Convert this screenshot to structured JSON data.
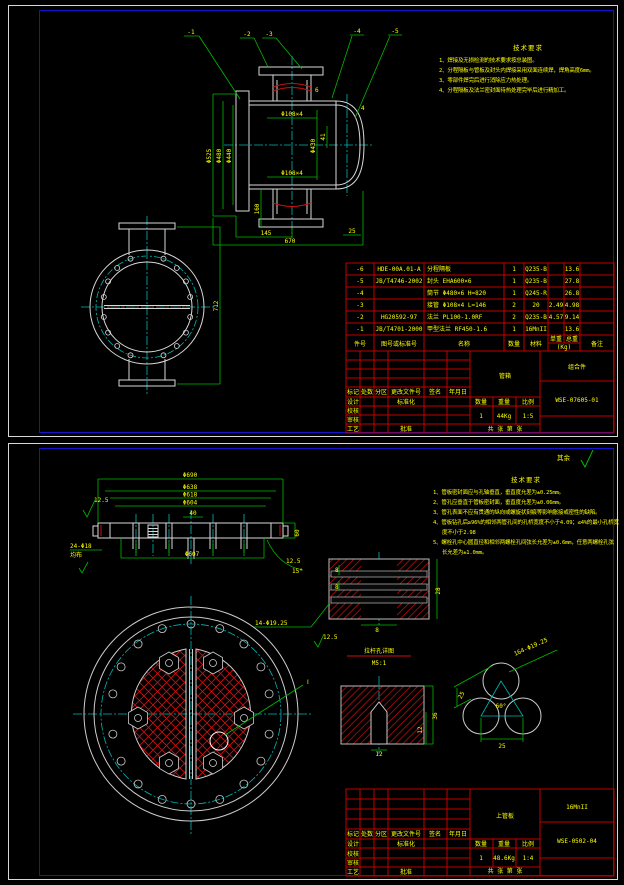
{
  "colors": {
    "background": "#000000",
    "geometry_line": "#d8d8d8",
    "dimension_line": "#00bb00",
    "annotation_text": "#ffff00",
    "centerline": "#00b7b7",
    "table_grid": "#c40000",
    "hatch_red": "#cc1111",
    "frame_blue": "#1414cc"
  },
  "sheet1": {
    "callouts": {
      "c1": "-1",
      "c2": "-2",
      "c3": "-3",
      "c4": "-4",
      "c5": "-5"
    },
    "tech": {
      "title": "技术要求",
      "l1": "1、焊接及无损检测的技术要求按总装图。",
      "l2": "2、分程隔板与管板及封头内焊接采用双面连续焊，焊角高度6mm。",
      "l3": "3、零部件焊完后进行消除应力热处理。",
      "l4": "4、分程隔板及法兰密封面待热处理完毕后进行精加工。"
    },
    "dims": {
      "dia_flange": "Φ525",
      "dia_shell": "Φ480",
      "dia_inner": "Φ440",
      "nozzle_top": "Φ108×4",
      "nozzle_bottom": "Φ108×4",
      "shell_thk": "6",
      "head_thk": "4",
      "dia_mid": "Φ430",
      "len_41": "41",
      "nozzle_height": "160",
      "len_145": "145",
      "len_670": "670",
      "len_25": "25",
      "height_712": "712"
    },
    "table": {
      "headers": {
        "no": "件号",
        "code": "图号或标准号",
        "name": "名称",
        "qty": "数量",
        "material": "材料",
        "unit": "单重",
        "total": "总重",
        "kg": "(Kg)",
        "note": "备注"
      },
      "rows": [
        {
          "no": "-6",
          "code": "HDE-00A.01-A",
          "name": "分程隔板",
          "qty": "1",
          "material": "Q235-B",
          "unit": "",
          "total": "13.6",
          "note": ""
        },
        {
          "no": "-5",
          "code": "JB/T4746-2002",
          "name": "封头 EHA600×6",
          "qty": "1",
          "material": "Q235-B",
          "unit": "",
          "total": "27.8",
          "note": ""
        },
        {
          "no": "-4",
          "code": "",
          "name": "筒节 Φ480×6 H=820",
          "qty": "1",
          "material": "Q245-R",
          "unit": "",
          "total": "26.8",
          "note": ""
        },
        {
          "no": "-3",
          "code": "",
          "name": "接管 Φ108×4 L=146",
          "qty": "2",
          "material": "20",
          "unit": "2.49",
          "total": "4.98",
          "note": ""
        },
        {
          "no": "-2",
          "code": "HG20592-97",
          "name": "法兰 PL100-1.0RF",
          "qty": "2",
          "material": "Q235-B",
          "unit": "4.57",
          "total": "9.14",
          "note": ""
        },
        {
          "no": "-1",
          "code": "JB/T4701-2000",
          "name": "甲型法兰 RF450-1.6",
          "qty": "1",
          "material": "16MnII",
          "unit": "",
          "total": "13.6",
          "note": ""
        }
      ]
    },
    "titleblock": {
      "name": "管箱",
      "kind": "组合件",
      "drawing_no": "WSE-07605-01",
      "qty": "1",
      "weight": "44Kg",
      "scale": "1:5"
    }
  },
  "sheet2": {
    "rest_label": "其余",
    "tech": {
      "title": "技术要求",
      "l1": "1、管板密封面应与孔轴垂直，垂直度允差为±0.25mm。",
      "l2": "2、管孔应垂直于管板密封面，垂直度允差为±0.06mm。",
      "l3": "3、管孔表面不应有贯通的纵向或螺旋状刻痕等影响胀接或密性的缺陷。",
      "l4": "4、管板钻孔后≥96%的相邻两管孔间的孔桥宽度不小于4.09；≤4%的最小孔桥宽度不小于2.98",
      "l5": "5、螺栓孔中心圆直径和相邻两螺栓孔间弦长允差为±0.6mm，任意两螺栓孔弦长允差为±1.0mm。"
    },
    "dims": {
      "dia_690": "Φ690",
      "dia_638": "Φ638",
      "dia_618": "Φ618",
      "dia_604": "Φ604",
      "dia_607": "Φ607",
      "bolt_holes": "24-Φ18",
      "bolt_holes2": "均布",
      "rough_1": "12.5",
      "rough_2": "12.5",
      "rough_3": "12.5",
      "thk_60": "60",
      "gap_40": "40",
      "angle_15": "15°",
      "rod_holes": "14-Φ19.25",
      "rod_8a": "8",
      "rod_8b": "8",
      "rod_8c": "8",
      "rod_28": "28",
      "slot_36": "36",
      "slot_12": "12",
      "slot_w12": "12",
      "tube_holes": "164-Φ19.25",
      "angle_60": "60°",
      "pitch_a": "25",
      "pitch_b": "25",
      "detail_mark": "Ⅰ"
    },
    "captions": {
      "detail1": "拉杆孔详图",
      "detail1_scale": "M5:1"
    },
    "titleblock": {
      "name": "上管板",
      "material": "16MnII",
      "drawing_no": "WSE-0502-04",
      "qty": "1",
      "weight": "48.6Kg",
      "scale": "1:4"
    }
  },
  "tb_labels": {
    "mark": "标记",
    "count": "处数",
    "zone": "分区",
    "change_doc": "更改文件号",
    "sign": "签名",
    "date": "年月日",
    "design": "设计",
    "check": "校核",
    "audit": "审核",
    "process": "工艺",
    "standard": "标准化",
    "approve": "批准",
    "qty_label": "数量",
    "weight_label": "重量",
    "scale_label": "比例",
    "pages": "共 张 第 张"
  }
}
